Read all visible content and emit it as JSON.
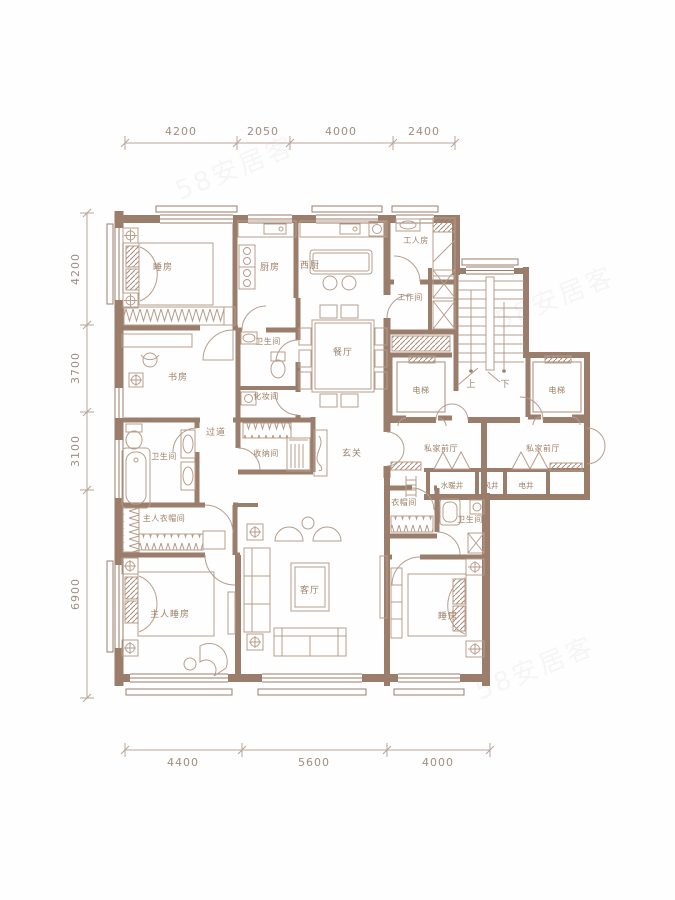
{
  "watermark": {
    "text": "58安居客"
  },
  "dimensions": {
    "top": [
      "4200",
      "2050",
      "4000",
      "2400"
    ],
    "left": [
      "4200",
      "3700",
      "3100",
      "6900"
    ],
    "bottom": [
      "4400",
      "5600",
      "4000"
    ]
  },
  "rooms": {
    "bedroom_top": "睡房",
    "kitchen": "厨房",
    "west_kitchen": "西厨",
    "worker_room": "工人房",
    "work_room": "工作间",
    "dining": "餐厅",
    "study": "书房",
    "bath_mid": "卫生间",
    "makeup": "化妆间",
    "corridor": "过道",
    "storage": "收纳间",
    "foyer": "玄关",
    "master_bath": "卫生间",
    "master_closet": "主人衣帽间",
    "master_bedroom": "主人睡房",
    "living": "客厅",
    "closet": "衣帽间",
    "bath_right": "卫生间",
    "bedroom_right": "睡房",
    "elevator": "电梯",
    "private_hall": "私家前厅",
    "water_shaft": "水暖井",
    "wind_shaft": "风井",
    "elec_shaft": "电井",
    "stairs_up": "上",
    "stairs_down": "下"
  },
  "colors": {
    "wall": "#9b7d6b",
    "furniture": "#b79d8c",
    "label": "#9d8168",
    "dimension": "#a08d7e"
  }
}
